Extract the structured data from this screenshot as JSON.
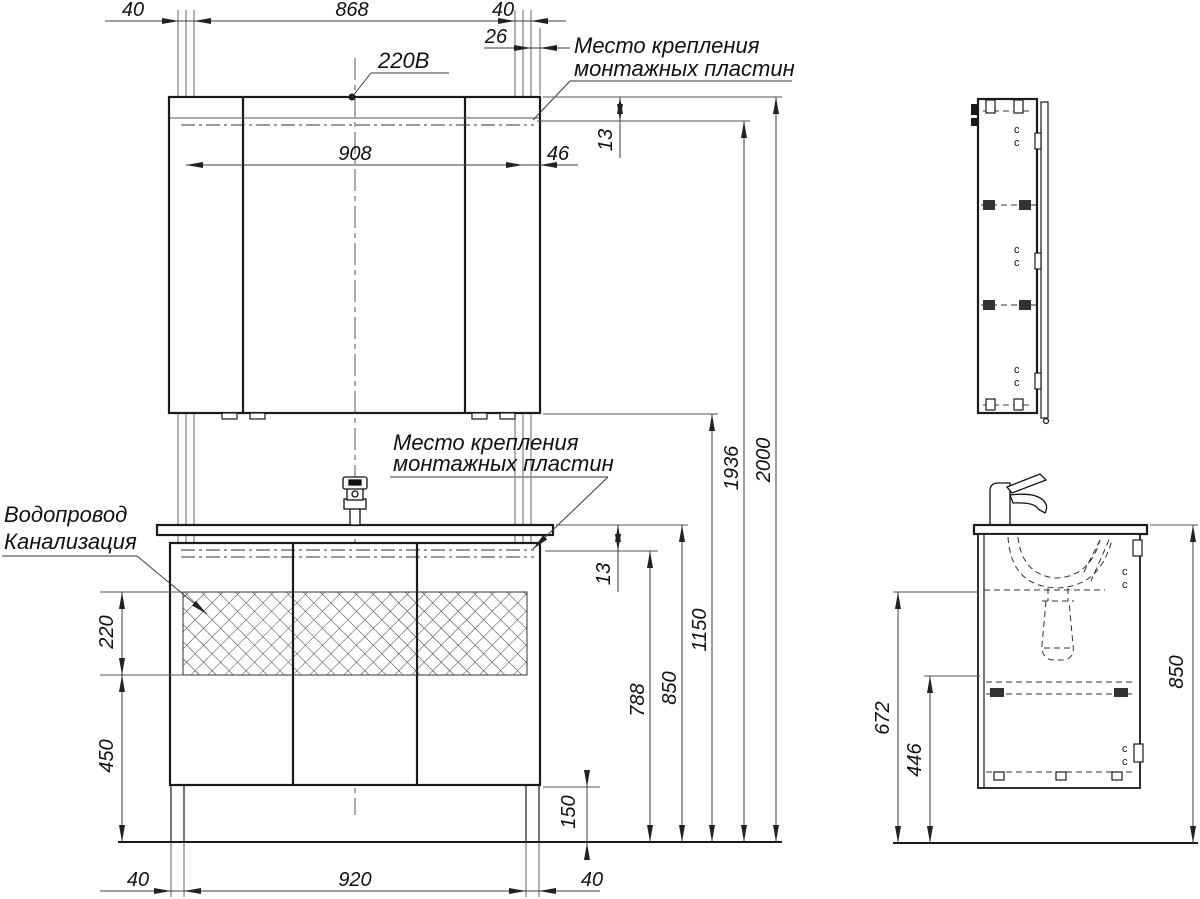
{
  "title": "Монтажная схема мебели для ванной",
  "colors": {
    "background": "#ffffff",
    "object_line": "#1a1a1a",
    "dimension_line": "#3c3c3c",
    "leader_underline": "#999999"
  },
  "labels": {
    "power_outlet": "220В",
    "mounting_plates_top": {
      "line1": "Место крепления",
      "line2": "монтажных пластин"
    },
    "mounting_plates_mid": {
      "line1": "Место крепления",
      "line2": "монтажных пластин"
    },
    "water_supply": "Водопровод",
    "sewerage": "Канализация",
    "hinge_mark": "c"
  },
  "dimensions_mm": {
    "top": {
      "left_offset": "40",
      "fixing_span": "868",
      "right_offset": "40",
      "plate_inset": "26",
      "inner_span": "908",
      "side_inset": "46",
      "plate_drop": "13"
    },
    "right": {
      "plate_drop_mid": "13",
      "plate_bottom_to_floor": "788",
      "counter_to_floor": "850",
      "mirror_bottom_to_floor": "1150",
      "plate_top_to_floor": "1936",
      "total_height": "2000"
    },
    "left": {
      "service_zone_height": "220",
      "zone_to_floor": "450"
    },
    "bottom": {
      "left_offset": "40",
      "legs_span": "920",
      "right_offset": "40",
      "plinth_height": "150"
    },
    "side": {
      "drain_to_floor": "672",
      "shelf_to_floor": "446",
      "counter_to_floor": "850"
    }
  }
}
